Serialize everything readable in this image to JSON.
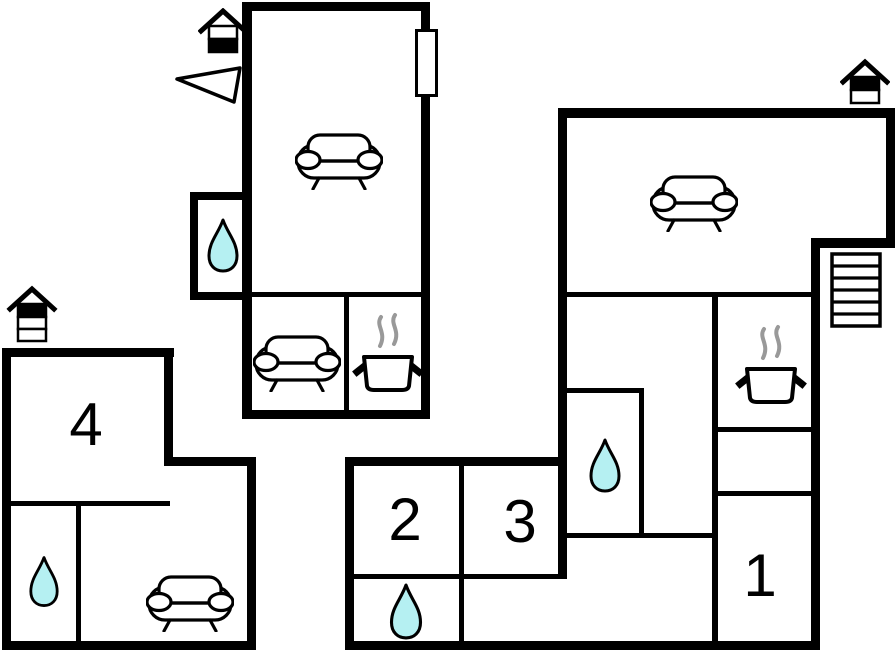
{
  "title": "apartment-floor-plan",
  "colors": {
    "wall": "#000000",
    "bg": "#ffffff",
    "water": "#b5f0f2",
    "steam": "#999999"
  },
  "rooms": {
    "room1": {
      "label": "1"
    },
    "room2": {
      "label": "2"
    },
    "room3": {
      "label": "3"
    },
    "room4": {
      "label": "4"
    }
  },
  "icons": {
    "sofa": "sofa-top-view",
    "water_drop": "teardrop-bathroom-marker",
    "stove": "cooking-pot-with-steam",
    "stairs": "staircase-flight",
    "house_top_unit": "house-marker-lower-level-filled",
    "house_left_unit": "house-marker-top-level-filled-of-three",
    "house_right_unit": "house-marker-upper-level-filled",
    "north_arrow": "triangle-direction-pointer",
    "window": "window-opening-marker"
  }
}
